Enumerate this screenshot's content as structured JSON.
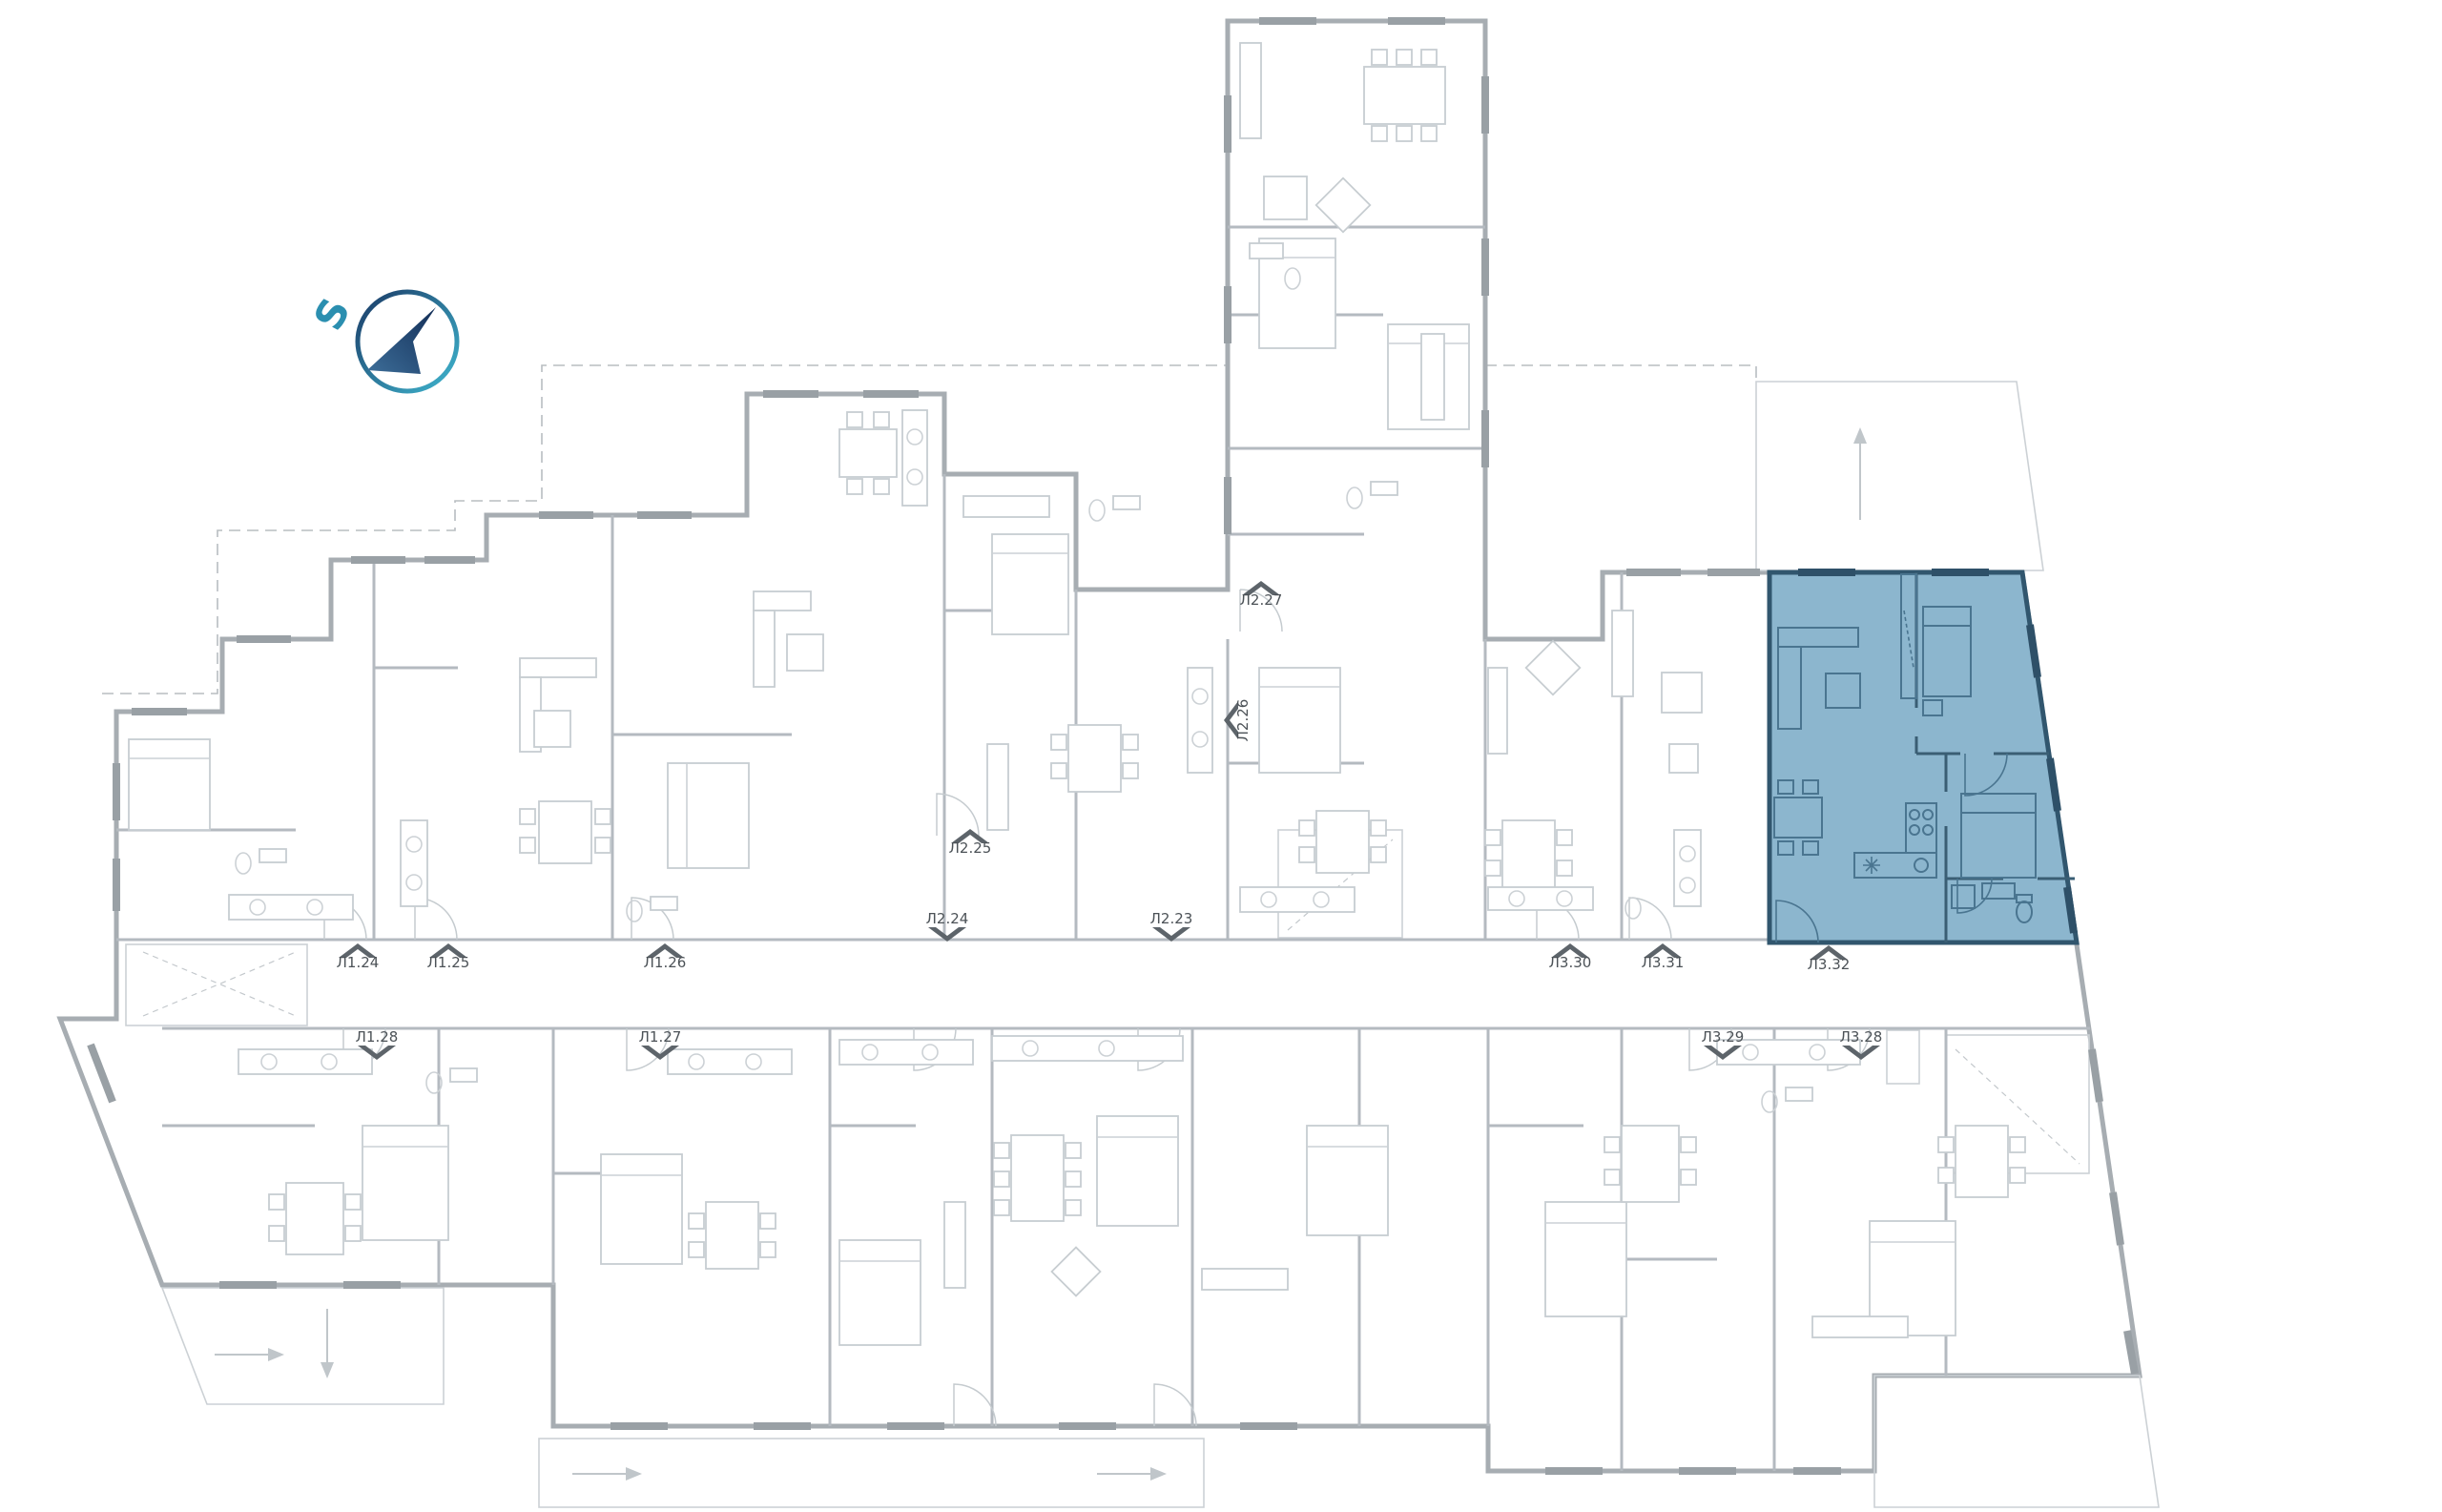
{
  "floorplan": {
    "compass": {
      "letter": "S"
    },
    "highlight_fill": "#8cb6ce",
    "highlighted_unit_id": "Л3.32",
    "units": [
      {
        "id": "Л1.24",
        "entrance": "up"
      },
      {
        "id": "Л1.25",
        "entrance": "up"
      },
      {
        "id": "Л1.26",
        "entrance": "up"
      },
      {
        "id": "Л1.28",
        "entrance": "down"
      },
      {
        "id": "Л1.27",
        "entrance": "down"
      },
      {
        "id": "Л2.25",
        "entrance": "up"
      },
      {
        "id": "Л2.24",
        "entrance": "down"
      },
      {
        "id": "Л2.23",
        "entrance": "down"
      },
      {
        "id": "Л2.27",
        "entrance": "up"
      },
      {
        "id": "Л2.26",
        "entrance": "left"
      },
      {
        "id": "Л3.30",
        "entrance": "up"
      },
      {
        "id": "Л3.31",
        "entrance": "up"
      },
      {
        "id": "Л3.32",
        "entrance": "up",
        "highlighted": true
      },
      {
        "id": "Л3.29",
        "entrance": "down"
      },
      {
        "id": "Л3.28",
        "entrance": "down"
      }
    ]
  }
}
